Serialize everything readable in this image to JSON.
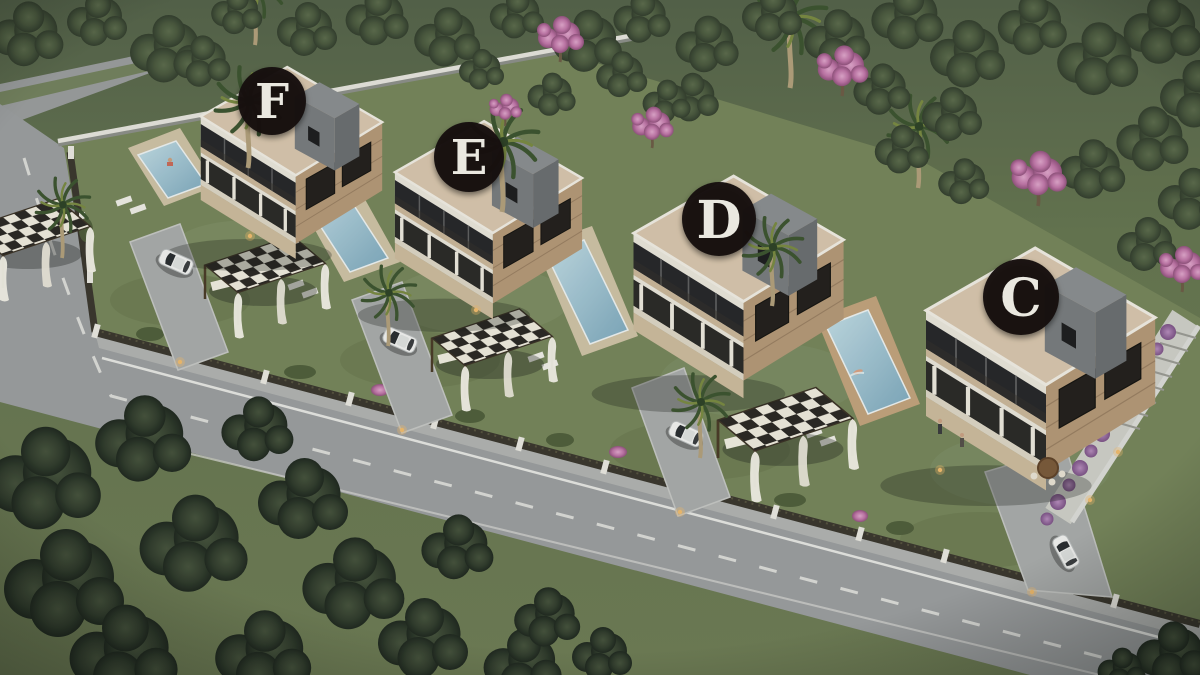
{
  "scene": {
    "type": "3d-architectural-site-render",
    "view": "aerial-isometric-dusk",
    "subject": "row of four modern two-storey villas with private pools, pergolas, palms, perimeter fence and a road, surrounded by dense trees"
  },
  "villas": [
    {
      "id": "villa-f",
      "label": "F"
    },
    {
      "id": "villa-e",
      "label": "E"
    },
    {
      "id": "villa-d",
      "label": "D"
    },
    {
      "id": "villa-c",
      "label": "C"
    }
  ],
  "badge": {
    "shape": "circle",
    "background": "#161110",
    "text_color": "#f5f2ea"
  },
  "features": {
    "pools": 4,
    "pergolas": 4,
    "cars": 4,
    "people_visible": 4
  },
  "palette": {
    "roof": "#d9c6ae",
    "wall_white": "#e9e5db",
    "brick": "#b59878",
    "tower_gray": "#76797c",
    "pool_water": "#9fc5d4",
    "pool_deck": "#cfc2a6",
    "lawn": "#76855b",
    "trees": "#49573e",
    "trees_dark": "#2c3629",
    "road": "#9b9da0",
    "road_marking": "#e3e3e0",
    "pergola_check_dark": "#2b2824",
    "pergola_check_light": "#efeade",
    "flower_pink": "#c77fae",
    "flower_purple": "#9c72a2",
    "car_white": "#f2f2f2"
  }
}
